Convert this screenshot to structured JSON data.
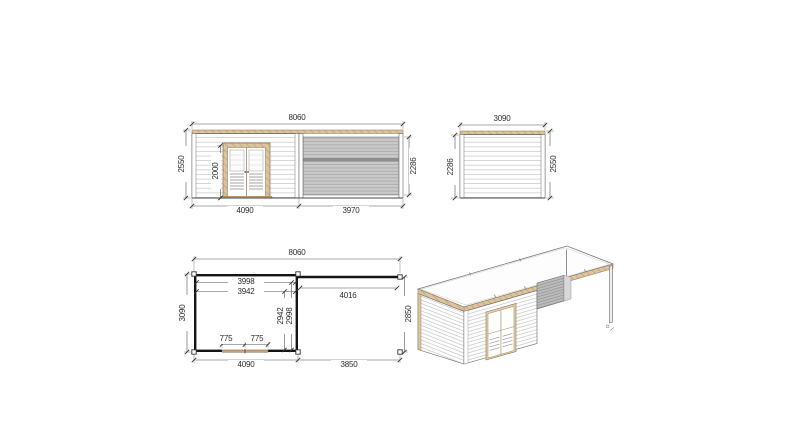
{
  "drawing": {
    "front_elevation": {
      "total_width": "8060",
      "height": "2550",
      "door_height": "2000",
      "canopy_height": "2286",
      "cabin_width": "4090",
      "canopy_width": "3970"
    },
    "side_elevation": {
      "width": "3090",
      "front_height": "2286",
      "back_height": "2550"
    },
    "floor_plan": {
      "total_width": "8060",
      "inner_width_a": "3998",
      "inner_width_b": "3942",
      "canopy_span": "4016",
      "depth": "3090",
      "inner_depth_a": "2942",
      "inner_depth_b": "2998",
      "door_leaf_a": "775",
      "door_leaf_b": "775",
      "cabin_width": "4090",
      "canopy_width": "3850",
      "canopy_depth": "2850"
    },
    "colors": {
      "wood": "#dcc49e",
      "wood_dark": "#8a7355",
      "panel_grey": "#c7c7c7",
      "wall_line": "#141414"
    }
  }
}
